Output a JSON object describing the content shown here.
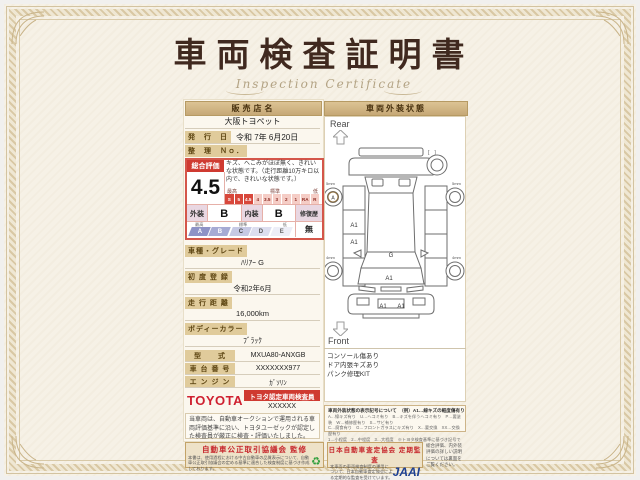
{
  "page": {
    "title": "車両検査証明書",
    "subtitle": "Inspection Certificate"
  },
  "dealer": {
    "label": "販売店名",
    "name": "大阪トヨペット"
  },
  "issue": {
    "label": "発　行　日",
    "value": "令和 7年 6月20日"
  },
  "ref_no": {
    "label": "整　理　Ｎｏ．"
  },
  "rating": {
    "label": "総合評価",
    "score": "4.5",
    "description": "キズ、へこみがほぼ無く、きれいな状態です。（走行距離10万キロ以内で、きれいな状態です。）",
    "scale_labels": {
      "high": "最高",
      "mid": "標準",
      "low": "低"
    },
    "scale": [
      "S",
      "5",
      "4.5",
      "4",
      "3.5",
      "3",
      "2",
      "1",
      "RA",
      "R"
    ],
    "exterior_label": "外装",
    "exterior_grade": "B",
    "interior_label": "内装",
    "interior_grade": "B",
    "grade_scale": [
      "A",
      "B",
      "C",
      "D",
      "E"
    ],
    "repair_label": "修復歴",
    "repair_value": "無"
  },
  "details": [
    {
      "label": "車種・グレード",
      "value": "ﾊﾘｱｰ G"
    },
    {
      "label": "初 度 登 録",
      "value": "令和2年6月"
    },
    {
      "label": "走 行 距 離",
      "value": "16,000km"
    },
    {
      "label": "ボディーカラー",
      "value": "ﾌﾞﾗｯｸ"
    },
    {
      "label": "型　　式",
      "value": "MXUA80-ANXGB"
    },
    {
      "label": "車 台 番 号",
      "value": "XXXXXXX977"
    },
    {
      "label": "エ ン ジ ン",
      "value": "ｶﾞｿﾘﾝ"
    }
  ],
  "inspector": {
    "brand": "TOYOTA",
    "badge": "トヨタ認定車両検査員",
    "id": "XXXXXX"
  },
  "left_note": "当車両は、自動車オークションで運用される車両評価基準に沿い、トヨタユーゼックが認定した検査員が厳正に検査・評価いたしました。",
  "exterior_panel": {
    "header": "車両外装状態",
    "rear_label": "Rear",
    "front_label": "Front",
    "spare_slot": "[　]",
    "marks": {
      "wheel": "A",
      "door_rear": "A1",
      "door_front": "A1",
      "glass": "G",
      "hood": "A1",
      "bumper_left": "A1",
      "bumper_right": "A1"
    },
    "tire_depth": {
      "rear_left": "5mm",
      "rear_right": "5mm",
      "front_left": "4mm",
      "front_right": "4mm"
    },
    "notes": [
      "コンソール傷あり",
      "ドア内張キズあり",
      "パンク修理KIT"
    ]
  },
  "legend": {
    "title": "車両外装状態の表示記号について",
    "example": "（例）A1…線キズの軽度傷有り",
    "lines": [
      "A…線キズ有り　U…ヘコミ有り　B…キズを伴うヘコミ有り　P…要塗装　W…補修歴有り　S…サビ有り",
      "C…腐食有り　G…フロントガラスにキズ有り　X…要交換　XX…交換歴有り",
      "1…小程度　2…中程度　3…大程度　※トヨタ検査基準に基づき記号で表示しています。"
    ]
  },
  "footer": {
    "left_title": "自動車公正取引協議会 監修",
    "left_text": "本書は、使用過程における中古自動車の品質表示について、自動車公正取引協議会の定める基準に適合した検査制度に基づき作成しております。",
    "right_title": "日本自動車査定協会 定期監査",
    "right_text": "本車両の車両検査制度の運用について、日本自動車査定協会による定期的な監査を受けています。",
    "jaai": "JAAI",
    "side_note": "総合評価、内外装評価の詳しい説明については裏面をご覧ください。"
  },
  "colors": {
    "accent_red": "#cf3a31",
    "frame_tan": "#c9b489",
    "jaai_blue": "#1d3f93",
    "seal_green": "#2e9e3a"
  }
}
